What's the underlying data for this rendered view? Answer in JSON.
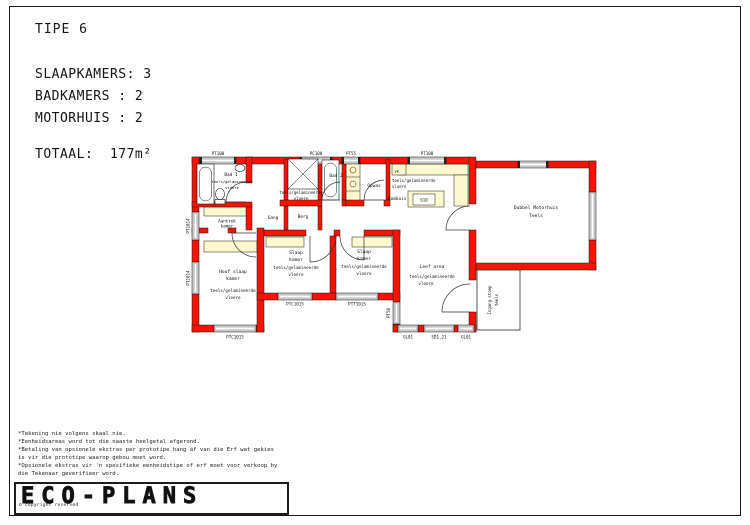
{
  "header": {
    "title": "TIPE 6",
    "stat1": "SLAAPKAMERS: 3",
    "stat2": "BADKAMERS : 2",
    "stat3": "MOTORHUIS : 2",
    "total": "TOTAAL:  177m²"
  },
  "plan": {
    "win_top": [
      "PT100",
      "PC100",
      "PT55",
      "PT100"
    ],
    "win_left": [
      "PT1014",
      "PT1014"
    ],
    "win_bottom": [
      "PTC1015",
      "PTC1015",
      "PTT1015"
    ],
    "win_right": "PT50",
    "doors_bottom": [
      "GL01",
      "SD1.21",
      "GL01"
    ],
    "rooms": {
      "bad1": {
        "name": "Bad 1",
        "f1": "teels/gelamineerde",
        "f2": "vloere"
      },
      "bad2": {
        "name": "Bad 2"
      },
      "opwas": {
        "name": "Opwas"
      },
      "kombuis": {
        "name": "Kombuis",
        "f1": "teels/gelamineerde",
        "f2": "vloere",
        "stove": "610",
        "fridge": "yk"
      },
      "gang": {
        "name": "Gang",
        "f1": "teels/gelamineerde",
        "f2": "vloere"
      },
      "berg": {
        "name": "Berg"
      },
      "aantrek": {
        "n1": "Aantrek",
        "n2": "kamer",
        "f1": "teels/gelamineerde",
        "f2": "vloere"
      },
      "hoofslaap": {
        "n1": "Hoof slaap",
        "n2": "kamer",
        "f1": "teels/gelamineerde",
        "f2": "vloere"
      },
      "slaap2": {
        "n1": "Slaap",
        "n2": "kamer",
        "f1": "teels/gelamineerde",
        "f2": "vloere"
      },
      "slaap3": {
        "n1": "Slaap",
        "n2": "kamer",
        "f1": "teels/gelamineerde",
        "f2": "vloere"
      },
      "leef": {
        "n1": "Leef area",
        "f1": "teels/gelamineerde",
        "f2": "vloere"
      },
      "motorhuis": {
        "n1": "Dubbel Motorhuis",
        "n2": "Teels"
      },
      "stoep": {
        "n1": "Ingang stoep",
        "n2": "teels"
      }
    }
  },
  "notes": {
    "line1": "*Tekening nie volgens skaal nie.",
    "line2": "*Eenheidsareas word tot die naaste heelgetal afgerond.",
    "line3": "*Betaling van opsionele ekstras per prototipe hang af van die Erf wat gekies",
    "line4": "is vir die prototipe waarop gebou moet word.",
    "line5": "*Opsionele ekstras vir 'n spesifieke eenheidstipe of erf moet voor verkoop by",
    "line6": "die Tekenaar geverifieer word.",
    "line7": "*Planne onderhewig aan goedkeuring."
  },
  "footer": {
    "logo": "ECO-PLANS",
    "copyright": "© copyright reserved"
  },
  "colors": {
    "wall_red": "#f01505",
    "cupboard_cream": "#fdf8cd",
    "window_gray": "#c7c7c7",
    "line_black": "#1a1a1a"
  }
}
